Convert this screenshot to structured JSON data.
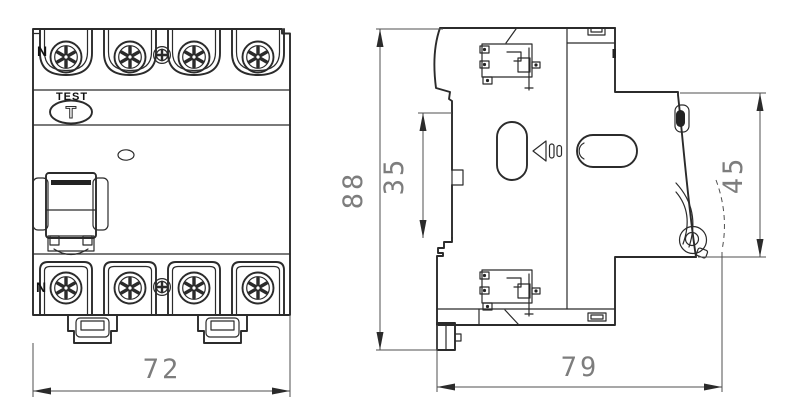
{
  "drawing": {
    "front_view": {
      "terminal_label_top": "N",
      "terminal_label_bottom": "N",
      "test_label": "TEST",
      "test_button_glyph": "T",
      "width_dim": "72"
    },
    "side_view": {
      "overall_height_dim": "88",
      "rail_section_dim": "35",
      "front_section_dim": "45",
      "depth_dim": "79"
    }
  },
  "colors": {
    "line": "#2b2b2b",
    "dimension_line": "#4f4f4f",
    "dimension_text": "#7d7d7d",
    "background": "#ffffff"
  }
}
